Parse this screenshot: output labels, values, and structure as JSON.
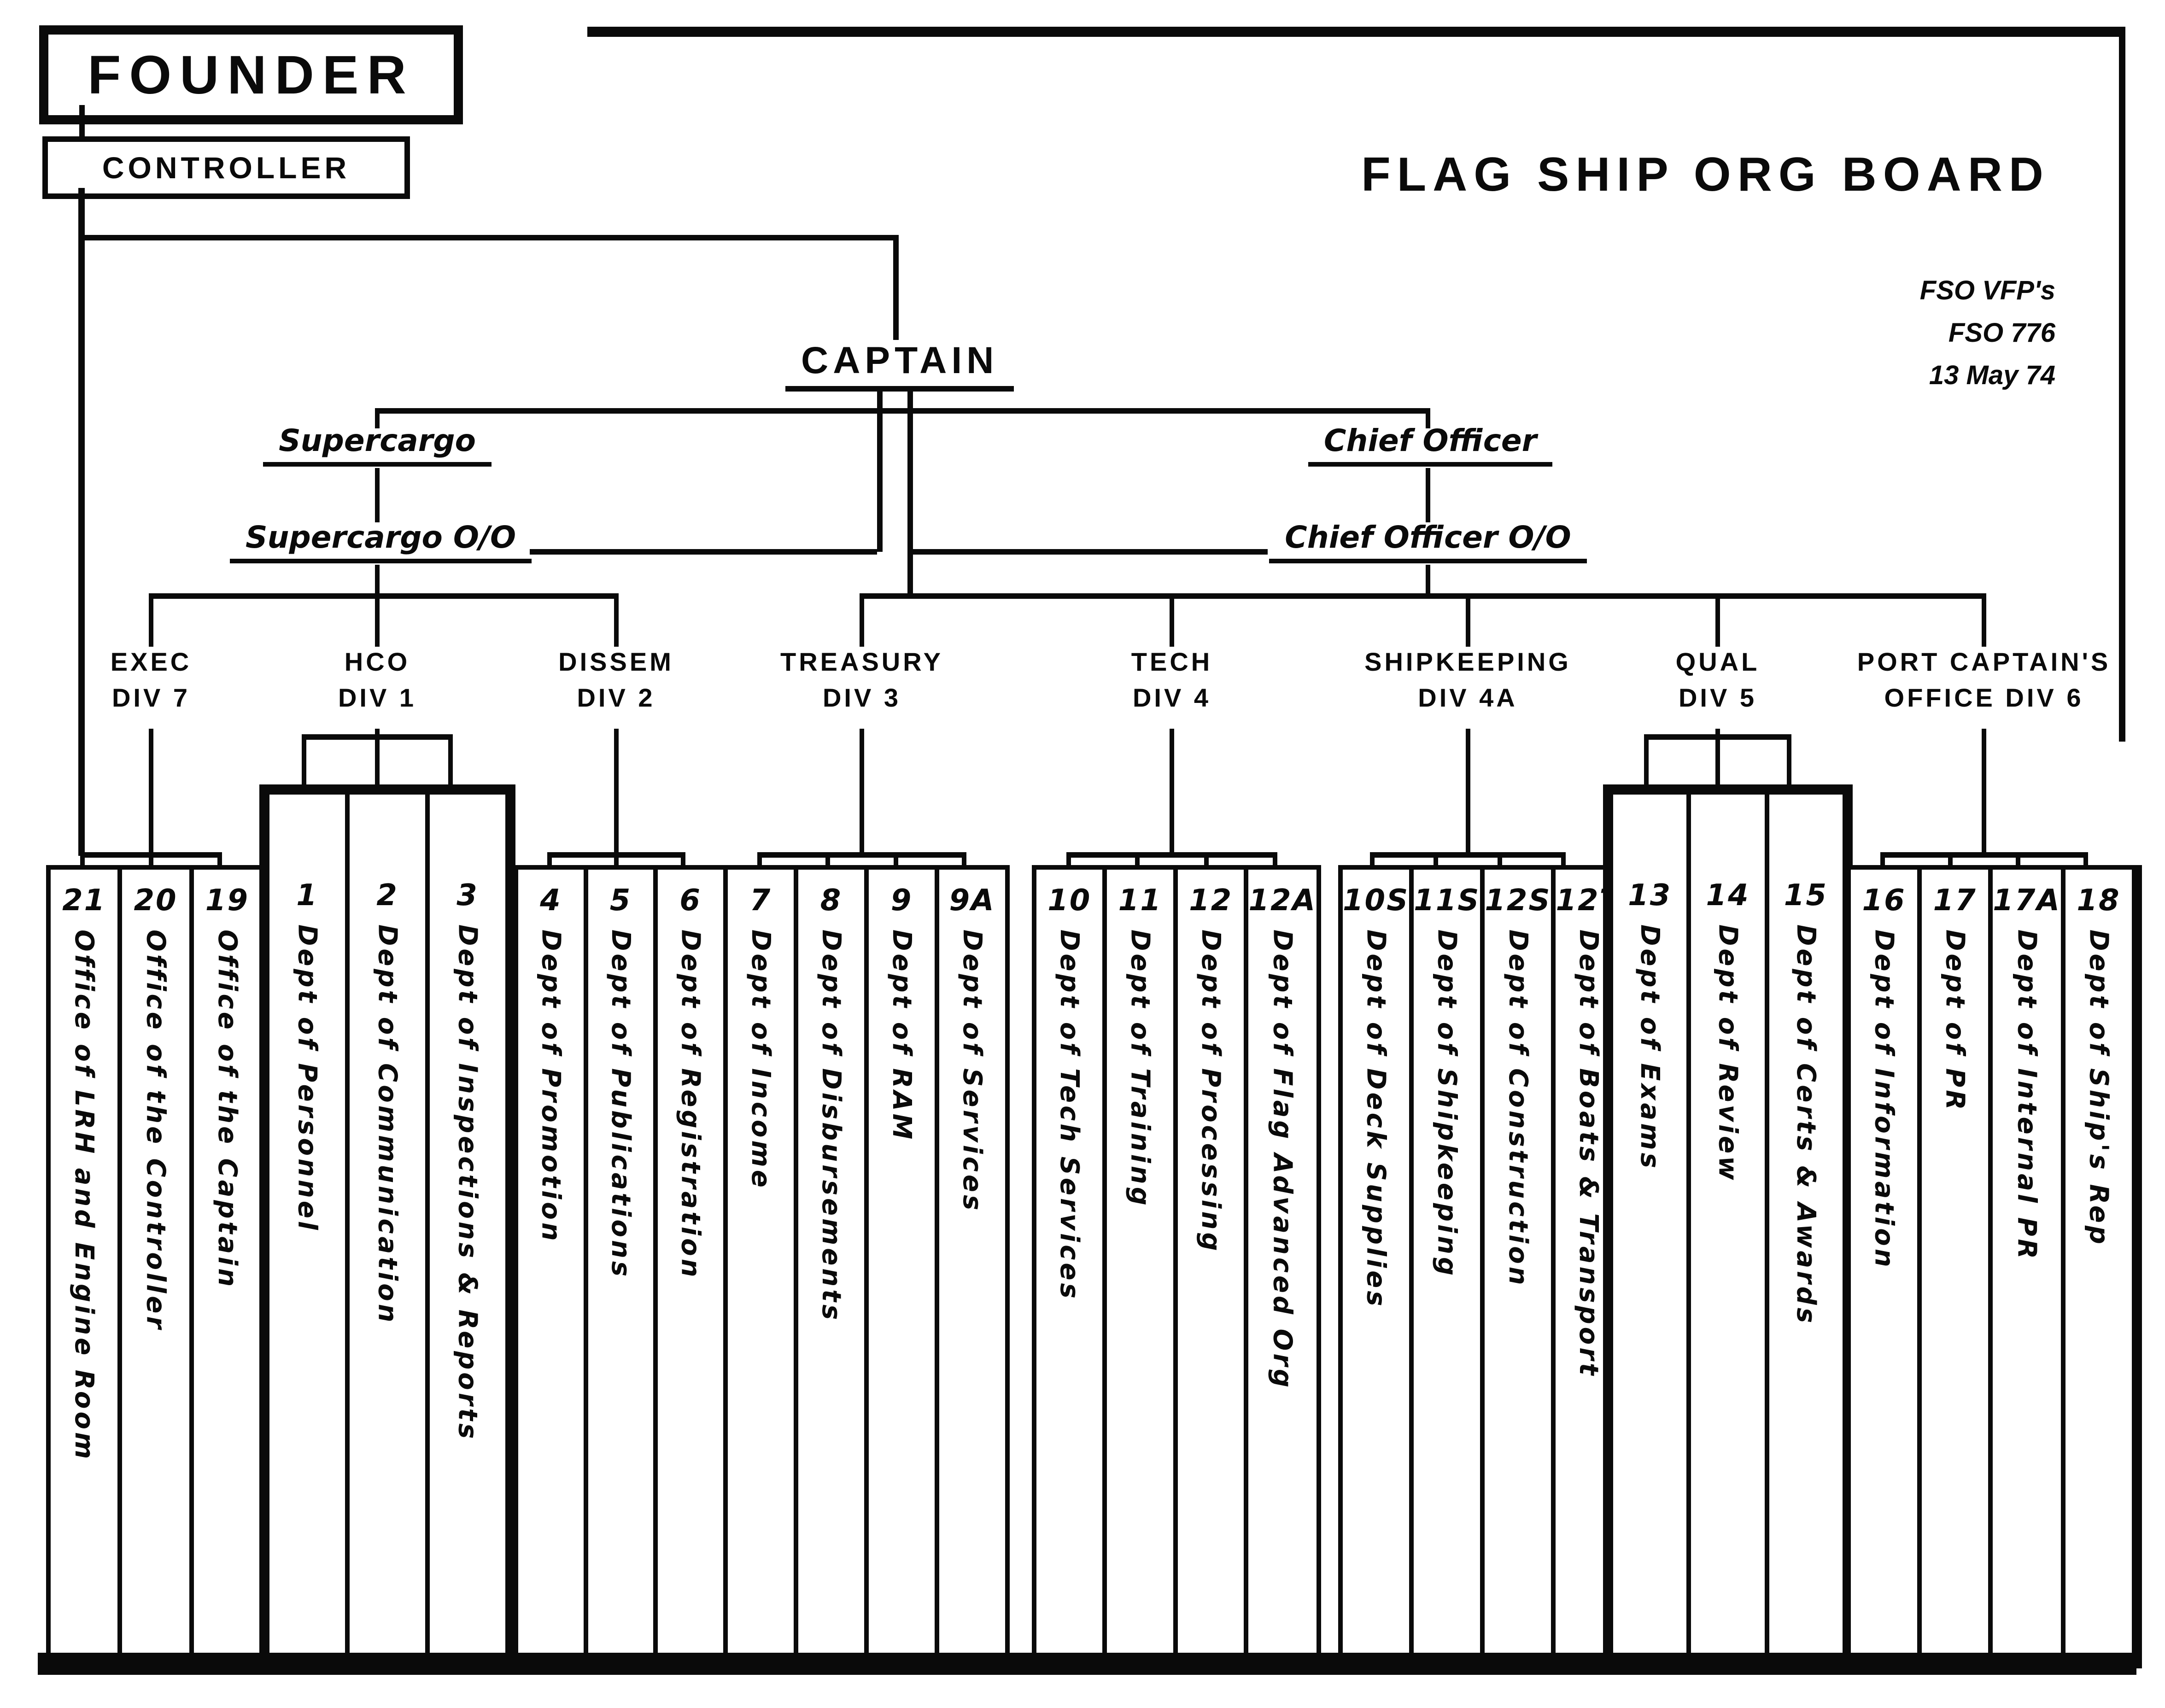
{
  "title": {
    "main": "FLAG SHIP ORG BOARD",
    "note1": "FSO VFP's",
    "note2": "FSO 776",
    "note3": "13 May 74"
  },
  "nodes": {
    "founder": "FOUNDER",
    "controller": "CONTROLLER",
    "captain": "CAPTAIN",
    "supercargo": "Supercargo",
    "supercargo_oo": "Supercargo O/O",
    "chief_officer": "Chief Officer",
    "chief_officer_oo": "Chief Officer O/O"
  },
  "divisions": [
    {
      "id": "exec",
      "line1": "EXEC",
      "line2": "DIV 7"
    },
    {
      "id": "hco",
      "line1": "HCO",
      "line2": "DIV 1"
    },
    {
      "id": "dissem",
      "line1": "DISSEM",
      "line2": "DIV 2"
    },
    {
      "id": "treasury",
      "line1": "TREASURY",
      "line2": "DIV 3"
    },
    {
      "id": "tech",
      "line1": "TECH",
      "line2": "DIV 4"
    },
    {
      "id": "shipkeeping",
      "line1": "SHIPKEEPING",
      "line2": "DIV 4A"
    },
    {
      "id": "qual",
      "line1": "QUAL",
      "line2": "DIV 5"
    },
    {
      "id": "port-captains-office",
      "line1": "PORT CAPTAIN'S",
      "line2": "OFFICE DIV 6"
    }
  ],
  "groups": [
    {
      "division": "exec",
      "departments": [
        {
          "num": "21",
          "label": "Office of LRH and Engine Room"
        },
        {
          "num": "20",
          "label": "Office of the Controller"
        },
        {
          "num": "19",
          "label": "Office of the Captain"
        }
      ]
    },
    {
      "division": "hco",
      "departments": [
        {
          "num": "1",
          "label": "Dept of Personnel"
        },
        {
          "num": "2",
          "label": "Dept of Communication"
        },
        {
          "num": "3",
          "label": "Dept of Inspections & Reports"
        }
      ]
    },
    {
      "division": "dissem",
      "departments": [
        {
          "num": "4",
          "label": "Dept of Promotion"
        },
        {
          "num": "5",
          "label": "Dept of Publications"
        },
        {
          "num": "6",
          "label": "Dept of Registration"
        }
      ]
    },
    {
      "division": "treasury",
      "departments": [
        {
          "num": "7",
          "label": "Dept of Income"
        },
        {
          "num": "8",
          "label": "Dept of Disbursements"
        },
        {
          "num": "9",
          "label": "Dept of RAM"
        },
        {
          "num": "9A",
          "label": "Dept of Services"
        }
      ]
    },
    {
      "division": "tech",
      "departments": [
        {
          "num": "10",
          "label": "Dept of Tech Services"
        },
        {
          "num": "11",
          "label": "Dept of Training"
        },
        {
          "num": "12",
          "label": "Dept of Processing"
        },
        {
          "num": "12A",
          "label": "Dept of Flag Advanced Org"
        }
      ]
    },
    {
      "division": "shipkeeping",
      "departments": [
        {
          "num": "10S",
          "label": "Dept of Deck Supplies"
        },
        {
          "num": "11S",
          "label": "Dept of Shipkeeping"
        },
        {
          "num": "12S",
          "label": "Dept of Construction"
        },
        {
          "num": "12T",
          "label": "Dept of Boats & Transport"
        }
      ]
    },
    {
      "division": "qual",
      "departments": [
        {
          "num": "13",
          "label": "Dept of Exams"
        },
        {
          "num": "14",
          "label": "Dept of Review"
        },
        {
          "num": "15",
          "label": "Dept of Certs & Awards"
        }
      ]
    },
    {
      "division": "port-captains-office",
      "departments": [
        {
          "num": "16",
          "label": "Dept of Information"
        },
        {
          "num": "17",
          "label": "Dept of PR"
        },
        {
          "num": "17A",
          "label": "Dept of Internal PR"
        },
        {
          "num": "18",
          "label": "Dept of Ship's Rep"
        }
      ]
    }
  ]
}
